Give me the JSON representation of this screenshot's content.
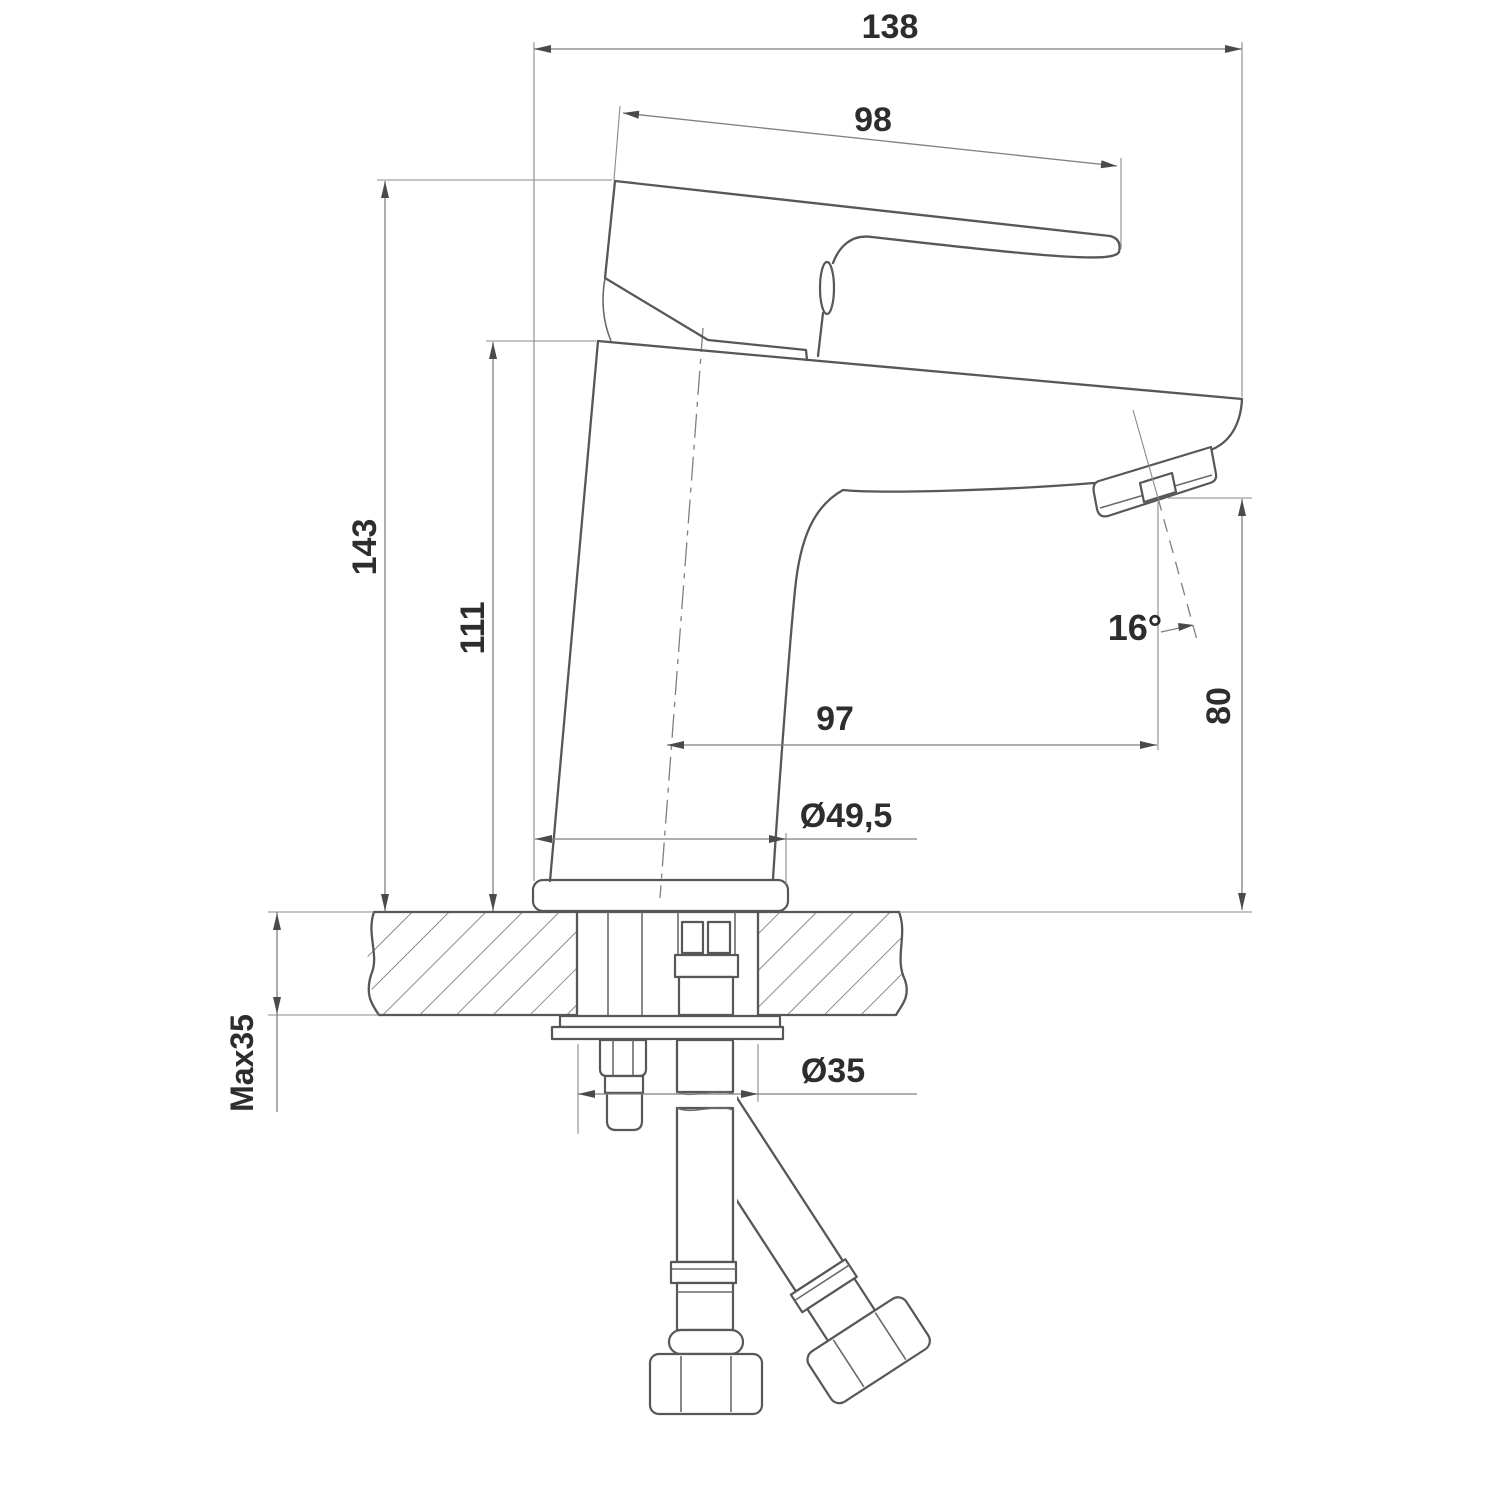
{
  "drawing": {
    "kind": "technical dimension drawing",
    "subject": "single-lever basin mixer tap, side elevation with counter mounting cross-section and supply hoses",
    "colors": {
      "background": "#ffffff",
      "geometry_line": "#575757",
      "dimension_line": "#7f7f7f",
      "label_text": "#2d2d2d"
    },
    "dimensions": {
      "overall_width": {
        "label": "138"
      },
      "handle_length": {
        "label": "98"
      },
      "total_height": {
        "label": "143"
      },
      "body_height": {
        "label": "111"
      },
      "spout_reach": {
        "label": "97"
      },
      "outlet_height": {
        "label": "80"
      },
      "outlet_angle": {
        "label": "16°"
      },
      "base_diameter": {
        "label": "Ø49,5"
      },
      "mounting_hole_diameter": {
        "label": "Ø35"
      },
      "max_deck_thickness": {
        "label": "Max35"
      }
    }
  }
}
